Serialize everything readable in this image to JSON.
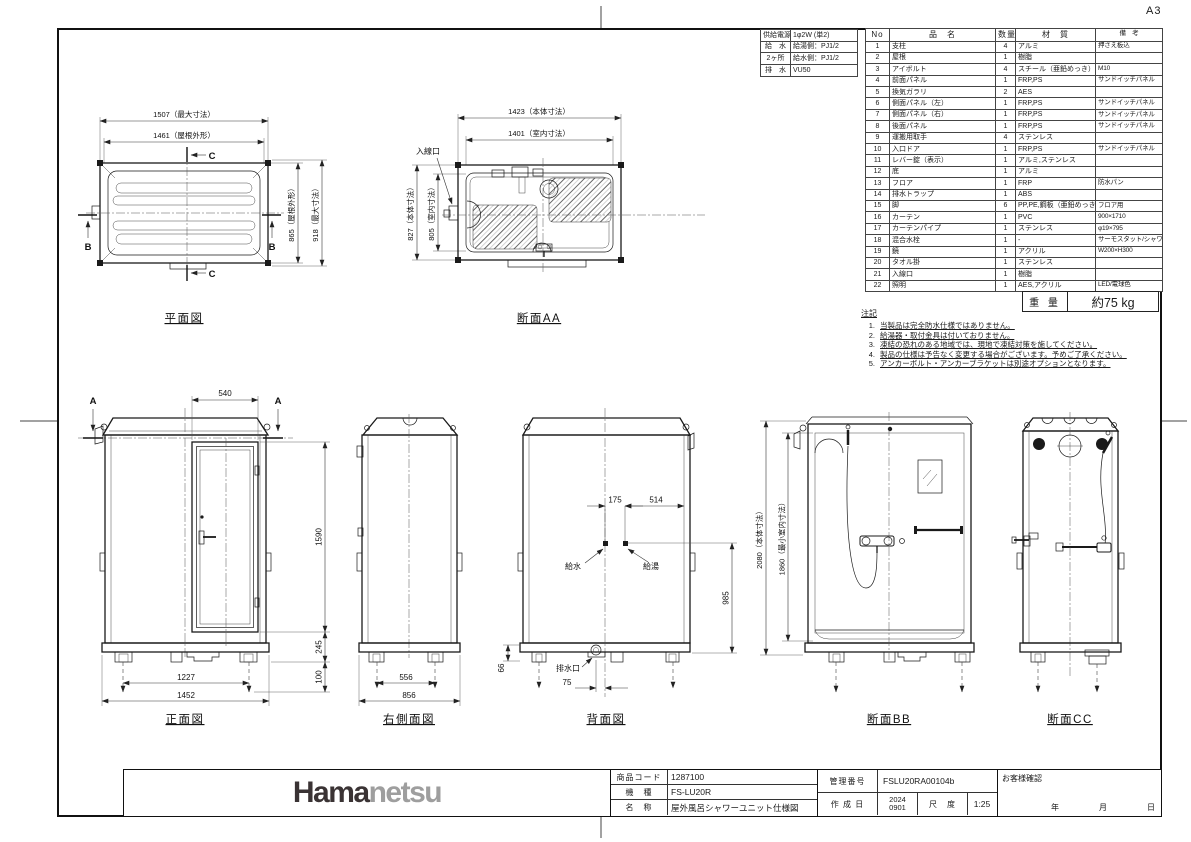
{
  "sheet": {
    "size": "A3"
  },
  "supply_table": {
    "rows": [
      {
        "label": "供給電源",
        "value": "1φ2W (単2)"
      },
      {
        "label": "給　水",
        "value": "給湯側：PJ1/2"
      },
      {
        "label": "2ヶ所",
        "value": "給水側：PJ1/2"
      },
      {
        "label": "排　水",
        "value": "VU50"
      }
    ]
  },
  "parts_table": {
    "headers": [
      "No",
      "品　名",
      "数量",
      "材　質",
      "備　考"
    ],
    "rows": [
      [
        "1",
        "支柱",
        "4",
        "アルミ",
        "押さえ板込"
      ],
      [
        "2",
        "屋根",
        "1",
        "樹脂",
        ""
      ],
      [
        "3",
        "アイボルト",
        "4",
        "スチール（亜鉛めっき）",
        "M10"
      ],
      [
        "4",
        "前面パネル",
        "1",
        "FRP,PS",
        "サンドイッチパネル"
      ],
      [
        "5",
        "換気ガラリ",
        "2",
        "AES",
        ""
      ],
      [
        "6",
        "側面パネル（左）",
        "1",
        "FRP,PS",
        "サンドイッチパネル"
      ],
      [
        "7",
        "側面パネル（右）",
        "1",
        "FRP,PS",
        "サンドイッチパネル"
      ],
      [
        "8",
        "後面パネル",
        "1",
        "FRP,PS",
        "サンドイッチパネル"
      ],
      [
        "9",
        "運搬用取手",
        "4",
        "ステンレス",
        ""
      ],
      [
        "10",
        "入口ドア",
        "1",
        "FRP,PS",
        "サンドイッチパネル"
      ],
      [
        "11",
        "レバー錠（表示）",
        "1",
        "アルミ,ステンレス",
        ""
      ],
      [
        "12",
        "底",
        "1",
        "アルミ",
        ""
      ],
      [
        "13",
        "フロア",
        "1",
        "FRP",
        "防水パン"
      ],
      [
        "14",
        "排水トラップ",
        "1",
        "ABS",
        ""
      ],
      [
        "15",
        "脚",
        "6",
        "PP,PE,鋼板（亜鉛めっき）",
        "フロア用"
      ],
      [
        "16",
        "カーテン",
        "1",
        "PVC",
        "900×1710"
      ],
      [
        "17",
        "カーテンパイプ",
        "1",
        "ステンレス",
        "φ19×795"
      ],
      [
        "18",
        "混合水栓",
        "1",
        "-",
        "サーモスタット/シャワー付"
      ],
      [
        "19",
        "鏡",
        "1",
        "アクリル",
        "W200×H300"
      ],
      [
        "20",
        "タオル掛",
        "1",
        "ステンレス",
        ""
      ],
      [
        "21",
        "入線口",
        "1",
        "樹脂",
        ""
      ],
      [
        "22",
        "照明",
        "1",
        "AES,アクリル",
        "LED/電球色"
      ]
    ]
  },
  "weight": {
    "label": "重 量",
    "value": "約75 kg"
  },
  "notes": {
    "title": "注記",
    "items": [
      "当製品は完全防水仕様ではありません。",
      "給湯器・取付金具は付いておりません。",
      "凍結の恐れのある地域では、現地で凍結対策を施してください。",
      "製品の仕様は予告なく変更する場合がございます。予めご了承ください。",
      "アンカーボルト・アンカーブラケットは別途オプションとなります。"
    ]
  },
  "views": {
    "plan": {
      "title": "平面図",
      "dim_max_width": "1507（最大寸法）",
      "dim_roof_width": "1461（屋根外形）",
      "dim_roof_depth": "865（屋根外形）",
      "dim_max_depth": "918（最大寸法）",
      "marker_b": "B",
      "marker_c": "C"
    },
    "section_aa": {
      "title": "断面AA",
      "dim_body_width": "1423（本体寸法）",
      "dim_inner_width": "1401（室内寸法）",
      "dim_body_depth": "827（本体寸法）",
      "dim_inner_depth": "805（室内寸法）",
      "label_cable_inlet": "入線口"
    },
    "front": {
      "title": "正面図",
      "dim_door_width": "540",
      "dim_door_height": "1590",
      "dim_base_height": "245",
      "dim_leg_height": "100",
      "dim_leg_span": "1227",
      "dim_width": "1452",
      "marker_a": "A"
    },
    "right_side": {
      "title": "右側面図",
      "dim_leg_span": "556",
      "dim_depth": "856"
    },
    "rear": {
      "title": "背面図",
      "dim_water_offset": "175",
      "dim_hot_offset": "514",
      "dim_inlet_height": "985",
      "dim_base": "66",
      "dim_drain_offset": "75",
      "label_water": "給水",
      "label_hot_water": "給湯",
      "label_drain": "排水口"
    },
    "section_bb": {
      "title": "断面BB",
      "dim_total_height": "2080（本体寸法）",
      "dim_room_height": "1860（最小室内寸法）"
    },
    "section_cc": {
      "title": "断面CC"
    }
  },
  "title_block": {
    "logo_dark": "Hama",
    "logo_light": "netsu",
    "product_code_label": "商品コード",
    "product_code": "1287100",
    "model_label": "機　種",
    "model": "FS-LU20R",
    "name_label": "名　称",
    "name": "屋外風呂シャワーユニット仕様図",
    "control_no_label": "管理番号",
    "control_no": "FSLU20RA00104b",
    "date_label": "作 成 日",
    "date_top": "2024",
    "date_bottom": "0901",
    "scale_label": "尺　度",
    "scale": "1:25",
    "customer_label": "お客様確認",
    "year": "年",
    "month": "月",
    "day": "日"
  }
}
